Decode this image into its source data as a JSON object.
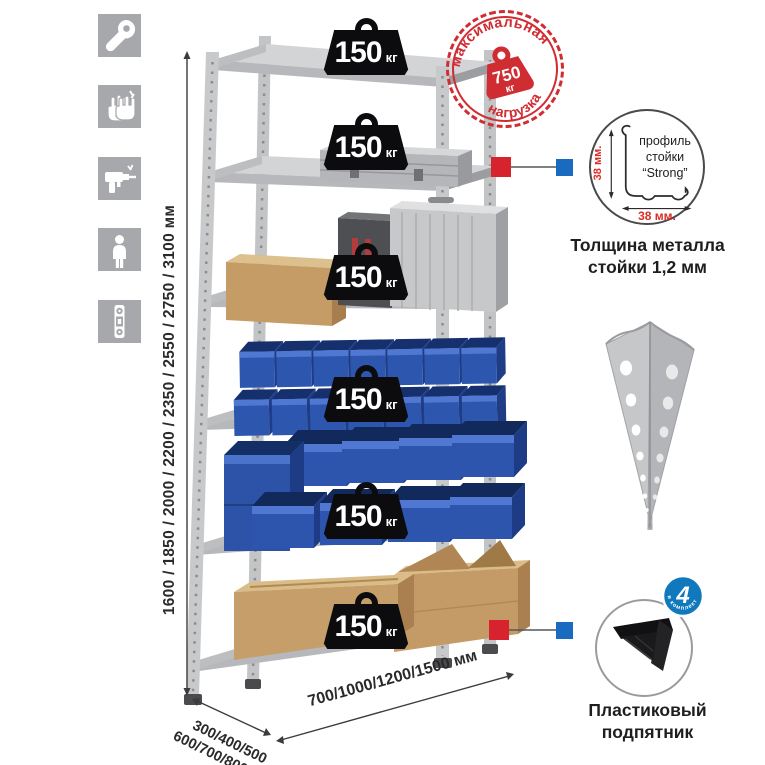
{
  "colors": {
    "stamp_red": "#d02d33",
    "callout_red": "#d6232e",
    "callout_blue": "#1a6bbf",
    "bin_blue": "#2d56af",
    "count_badge_blue": "#1079be",
    "icon_tile_gray": "#a7a8ab"
  },
  "left_toolbar": {
    "items": [
      {
        "icon": "wrench"
      },
      {
        "icon": "gloves"
      },
      {
        "icon": "drill"
      },
      {
        "icon": "person"
      },
      {
        "icon": "level"
      }
    ]
  },
  "height_dimension": {
    "label": "1600 / 1850 / 2000 / 2200 / 2350 / 2550 / 2750 / 3100 мм"
  },
  "depth_dimension": {
    "line1": "300/400/500",
    "line2": "600/700/800 мм"
  },
  "width_dimension": {
    "label": "700/1000/1200/1500 мм"
  },
  "rack": {
    "shelves": [
      {
        "load": "150",
        "unit": "кг"
      },
      {
        "load": "150",
        "unit": "кг"
      },
      {
        "load": "150",
        "unit": "кг"
      },
      {
        "load": "150",
        "unit": "кг"
      },
      {
        "load": "150",
        "unit": "кг"
      },
      {
        "load": "150",
        "unit": "кг"
      }
    ]
  },
  "stamp": {
    "arc_top": "максимальная",
    "arc_bottom": "нагрузка",
    "value": "750",
    "unit": "кг"
  },
  "profile_detail": {
    "text_lines": [
      "профиль",
      "стойки",
      "“Strong”"
    ],
    "vertical_dim": "38 мм.",
    "horizontal_dim": "38 мм.",
    "caption": [
      "Толщина металла",
      "стойки 1,2 мм"
    ]
  },
  "foot_detail": {
    "badge_value": "4",
    "badge_arc": "в комплекте",
    "caption": [
      "Пластиковый",
      "подпятник"
    ]
  }
}
